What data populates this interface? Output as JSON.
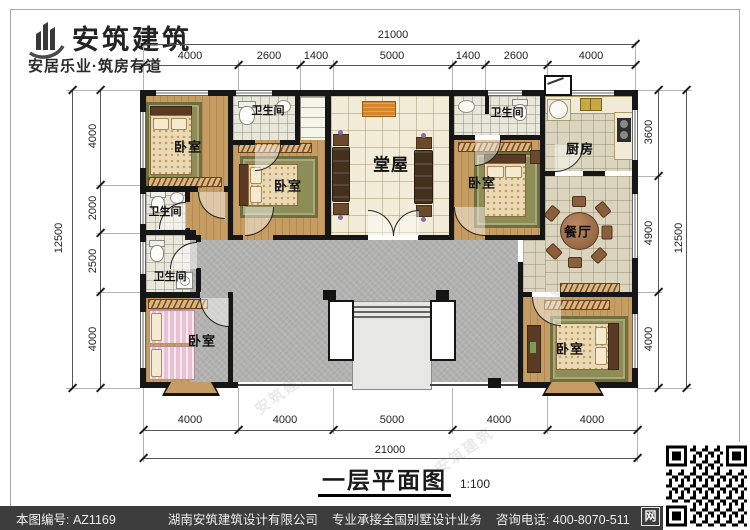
{
  "logo": {
    "name": "安筑建筑",
    "tagline": "安居乐业·筑房有道"
  },
  "dims": {
    "top_total": "21000",
    "top_segments": [
      "4000",
      "2600",
      "1400",
      "5000",
      "1400",
      "2600",
      "4000"
    ],
    "left_total": "12500",
    "left_segments": [
      "4000",
      "2000",
      "2500",
      "4000"
    ],
    "right_total": "12500",
    "right_segments": [
      "3600",
      "4900",
      "4000"
    ],
    "bottom_total": "21000",
    "bottom_segments": [
      "4000",
      "4000",
      "5000",
      "4000",
      "4000"
    ]
  },
  "rooms": {
    "bedroom": "卧室",
    "bathroom": "卫生间",
    "hall": "堂屋",
    "kitchen": "厨房",
    "dining": "餐厅"
  },
  "title": {
    "text": "一层平面图",
    "scale": "1:100"
  },
  "footer": {
    "number": "本图编号: AZ1169",
    "company": "湖南安筑建筑设计有限公司",
    "service": "专业承接全国别墅设计业务",
    "phone": "咨询电话: 400-8070-511",
    "web_badge": "网"
  },
  "watermark": "安筑建筑"
}
